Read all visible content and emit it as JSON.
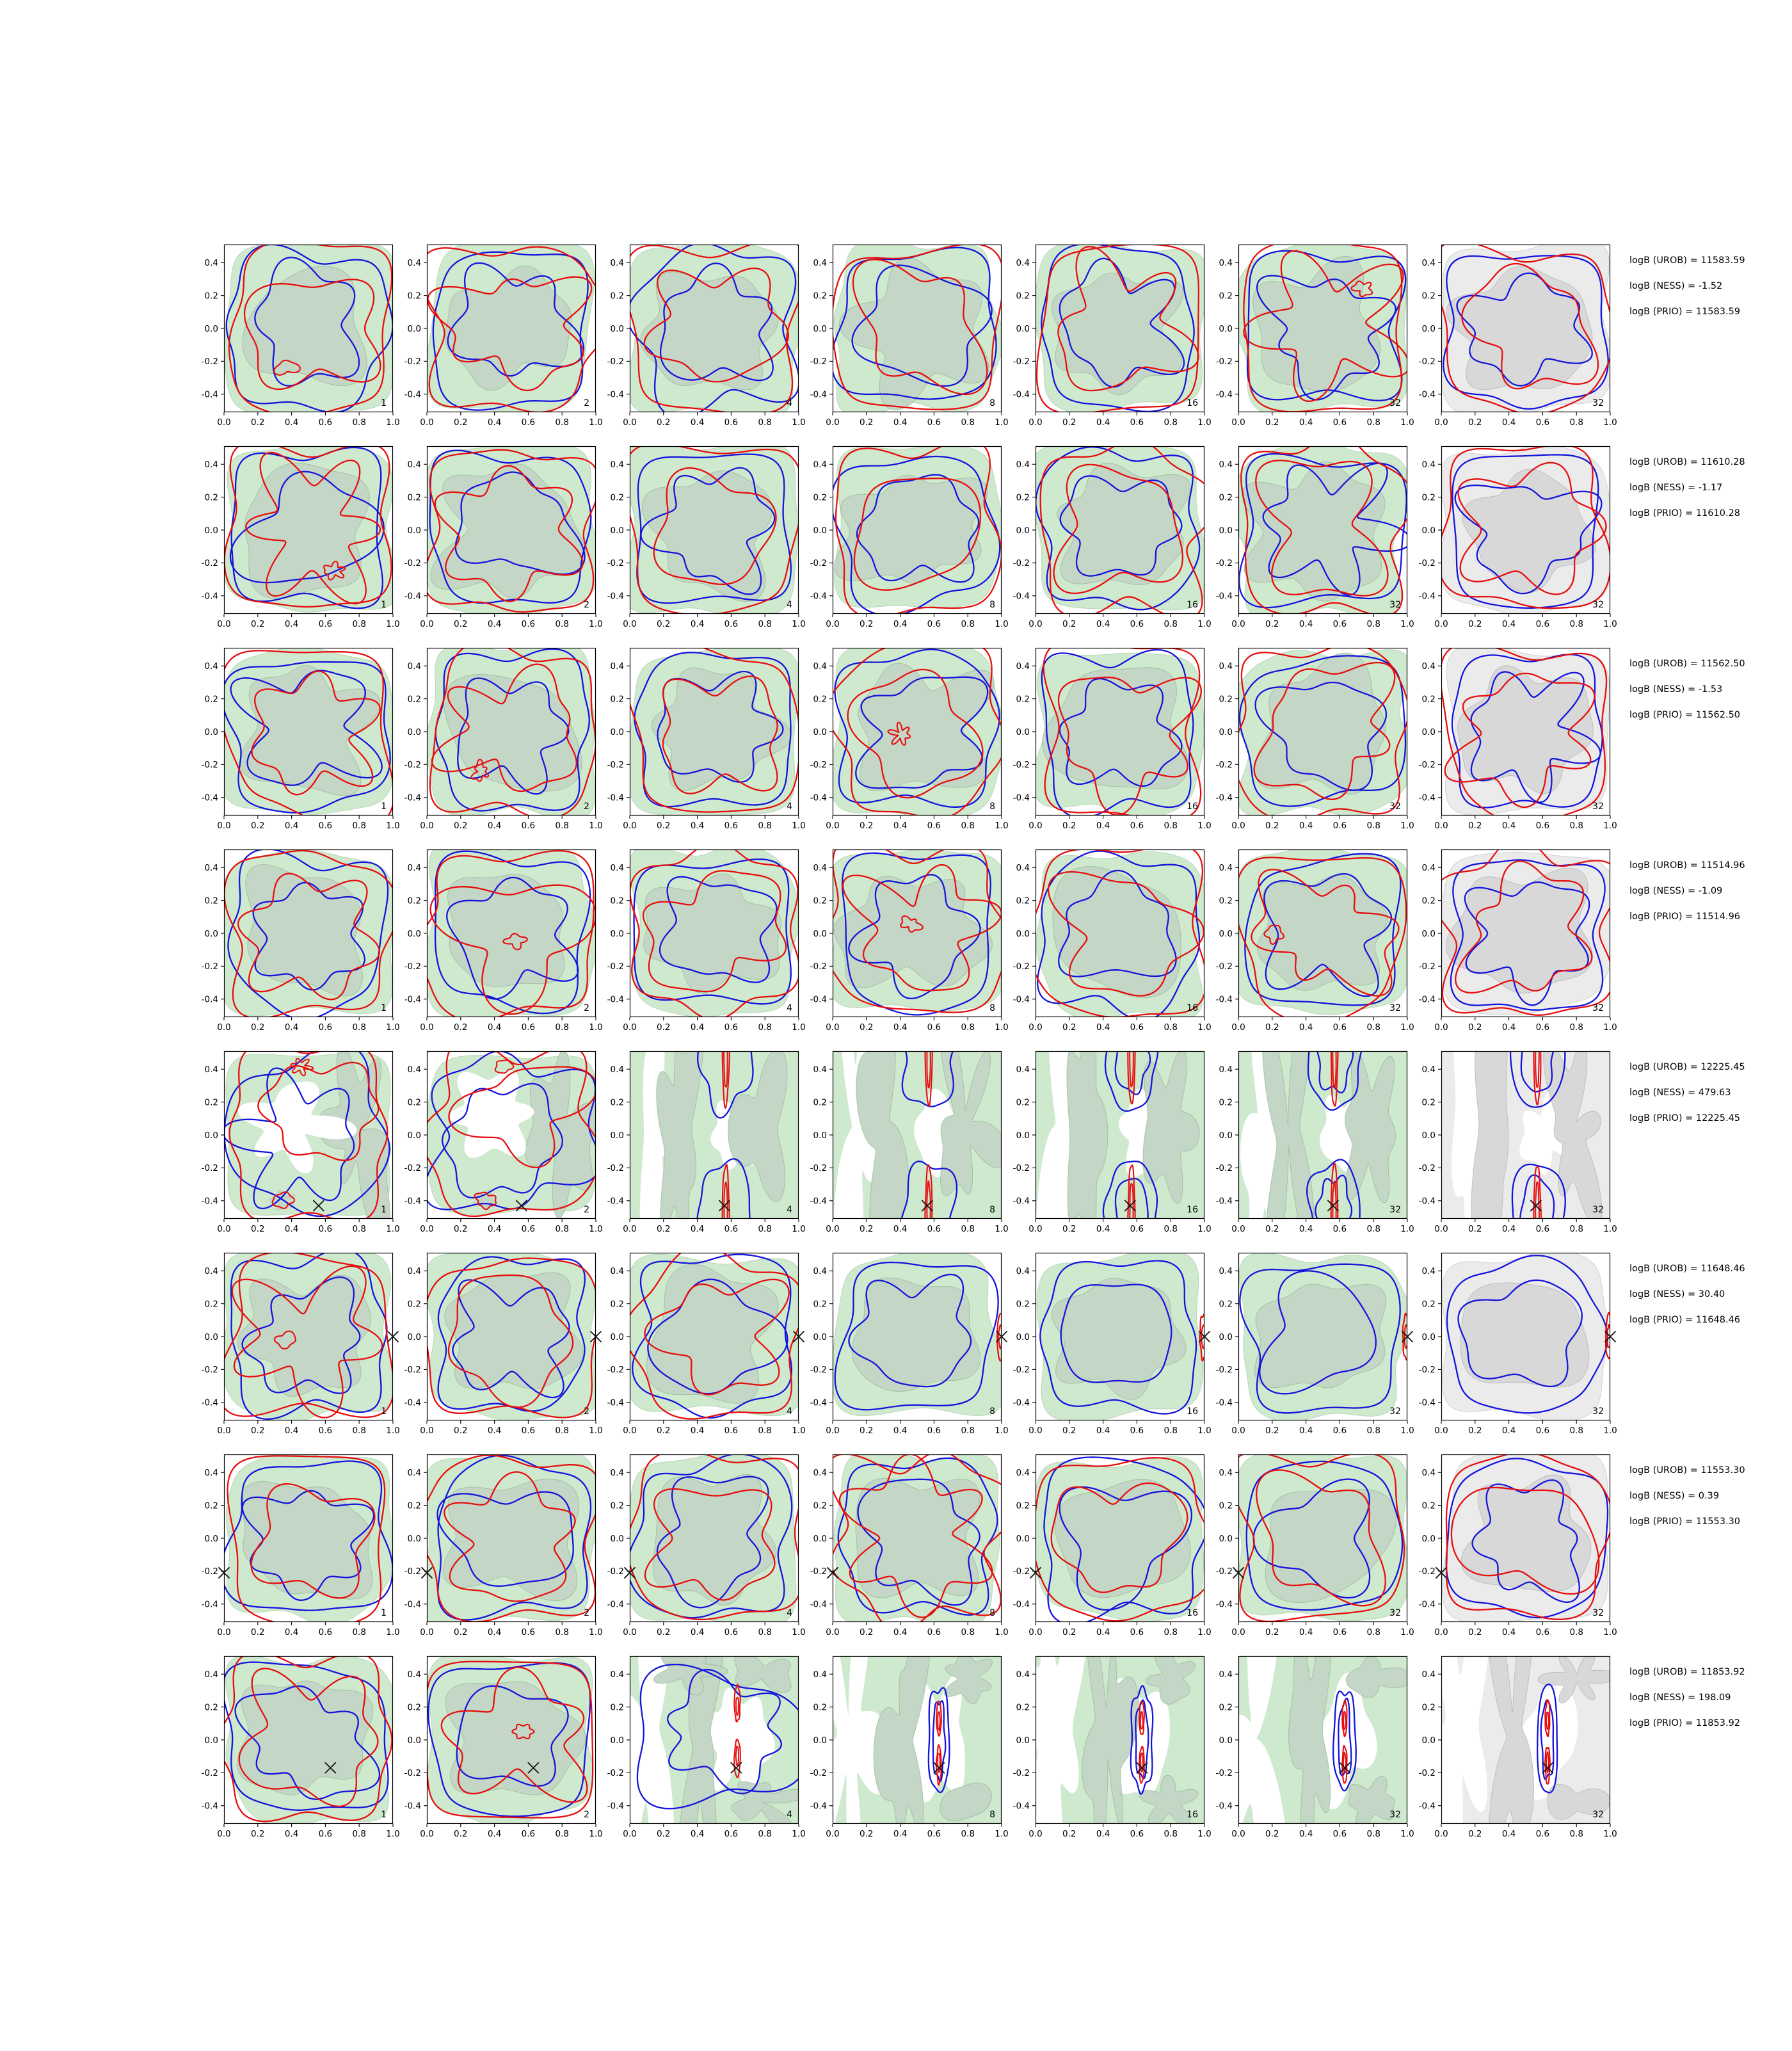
{
  "chart_data": {
    "type": "contour-grid",
    "description": "8x7 grid of 2D posterior density contour plots (red and blue KDE contour lines over green/gray filled density regions) with per-row Bayes factor annotations",
    "rows_count": 8,
    "cols_count": 7,
    "column_labels": [
      "1",
      "2",
      "4",
      "8",
      "16",
      "32",
      "32"
    ],
    "x_ticks": [
      "0.0",
      "0.2",
      "0.4",
      "0.6",
      "0.8",
      "1.0"
    ],
    "y_ticks": [
      "0.4",
      "0.2",
      "0.0",
      "-0.2",
      "-0.4"
    ],
    "x_tick_values": [
      0,
      0.2,
      0.4,
      0.6,
      0.8,
      1.0
    ],
    "y_tick_values": [
      0.4,
      0.2,
      0.0,
      -0.2,
      -0.4
    ],
    "xlim": [
      0,
      1
    ],
    "ylim": [
      -0.51,
      0.51
    ],
    "legend_position": "none",
    "grid_lines": false,
    "rows": [
      {
        "annotations": [
          "logB (UROB) = 11583.59",
          "logB (NESS) = -1.52",
          "logB (PRIO) = 11583.59"
        ],
        "logB_UROB": 11583.59,
        "logB_NESS": -1.52,
        "logB_PRIO": 11583.59,
        "marker": null,
        "panel_types": [
          "broad",
          "broad",
          "broad",
          "broad",
          "broad",
          "broad",
          "broad"
        ]
      },
      {
        "annotations": [
          "logB (UROB) = 11610.28",
          "logB (NESS) = -1.17",
          "logB (PRIO) = 11610.28"
        ],
        "logB_UROB": 11610.28,
        "logB_NESS": -1.17,
        "logB_PRIO": 11610.28,
        "marker": null,
        "panel_types": [
          "broad",
          "broad",
          "broad",
          "broad",
          "broad",
          "broad",
          "broad"
        ]
      },
      {
        "annotations": [
          "logB (UROB) = 11562.50",
          "logB (NESS) = -1.53",
          "logB (PRIO) = 11562.50"
        ],
        "logB_UROB": 11562.5,
        "logB_NESS": -1.53,
        "logB_PRIO": 11562.5,
        "marker": null,
        "panel_types": [
          "broad",
          "broad",
          "broad",
          "broad",
          "broad",
          "broad",
          "broad"
        ]
      },
      {
        "annotations": [
          "logB (UROB) = 11514.96",
          "logB (NESS) = -1.09",
          "logB (PRIO) = 11514.96"
        ],
        "logB_UROB": 11514.96,
        "logB_NESS": -1.09,
        "logB_PRIO": 11514.96,
        "marker": null,
        "panel_types": [
          "broad",
          "broad",
          "broad",
          "broad",
          "broad",
          "broad",
          "broad"
        ]
      },
      {
        "annotations": [
          "logB (UROB) = 12225.45",
          "logB (NESS) = 479.63",
          "logB (PRIO) = 12225.45"
        ],
        "logB_UROB": 12225.45,
        "logB_NESS": 479.63,
        "logB_PRIO": 12225.45,
        "marker": [
          0.56,
          -0.43
        ],
        "panel_types": [
          "hole",
          "hole",
          "bands",
          "bands",
          "bands",
          "bands",
          "bands"
        ]
      },
      {
        "annotations": [
          "logB (UROB) = 11648.46",
          "logB (NESS) = 30.40",
          "logB (PRIO) = 11648.46"
        ],
        "logB_UROB": 11648.46,
        "logB_NESS": 30.4,
        "logB_PRIO": 11648.46,
        "marker": [
          1.0,
          0.0
        ],
        "panel_types": [
          "broad",
          "broad",
          "broad",
          "edge",
          "edge",
          "edge",
          "edge"
        ]
      },
      {
        "annotations": [
          "logB (UROB) = 11553.30",
          "logB (NESS) = 0.39",
          "logB (PRIO) = 11553.30"
        ],
        "logB_UROB": 11553.3,
        "logB_NESS": 0.39,
        "logB_PRIO": 11553.3,
        "marker": [
          0.0,
          -0.21
        ],
        "panel_types": [
          "broad",
          "broad",
          "broad",
          "broad",
          "broad",
          "broad",
          "broad"
        ]
      },
      {
        "annotations": [
          "logB (UROB) = 11853.92",
          "logB (NESS) = 198.09",
          "logB (PRIO) = 11853.92"
        ],
        "logB_UROB": 11853.92,
        "logB_NESS": 198.09,
        "logB_PRIO": 11853.92,
        "marker": [
          0.63,
          -0.17
        ],
        "panel_types": [
          "broad",
          "broad",
          "capsule-loose",
          "capsule",
          "capsule",
          "capsule",
          "capsule"
        ]
      }
    ],
    "colors": {
      "red": "#e60e0e",
      "blue": "#1414dc",
      "green_fill": "#cfe9cf",
      "green_inner": "#c4d6c6",
      "gray_fill": "#ebebeb",
      "gray_inner": "#d8d8d8",
      "axis": "#000000",
      "marker": "#111111",
      "background": "#ffffff"
    }
  }
}
